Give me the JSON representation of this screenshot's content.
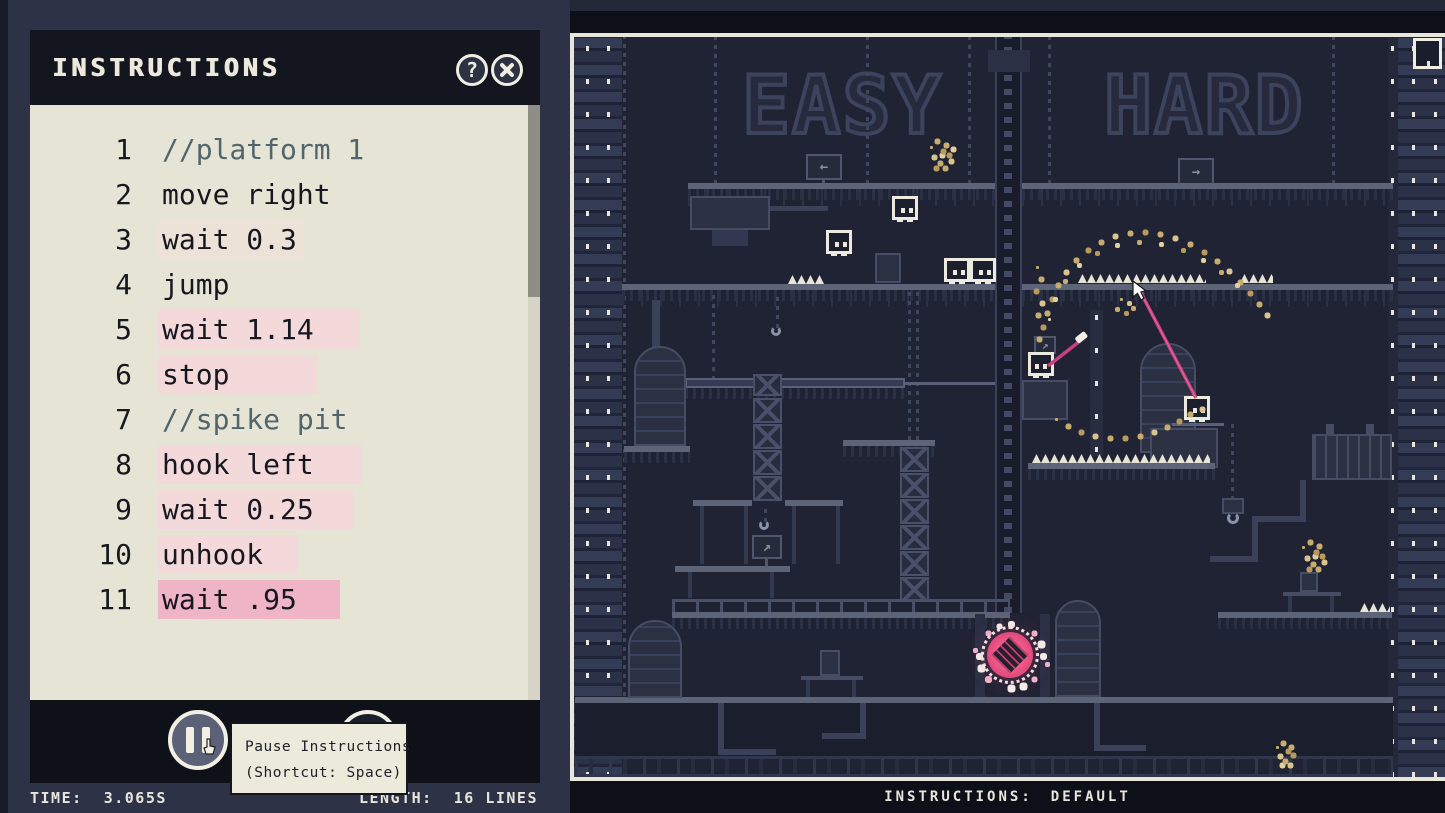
{
  "panel": {
    "title": "INSTRUCTIONS",
    "icons": {
      "help_glyph": "?"
    },
    "tooltip": {
      "line1": "Pause Instructions",
      "line2": "(Shortcut: Space)"
    },
    "footer": {
      "time_label": "TIME:",
      "time_value": "3.065S",
      "length_label": "LENGTH:",
      "length_value": "16 LINES"
    }
  },
  "editor": {
    "lines": [
      {
        "n": 1,
        "text": "//platform 1",
        "type": "comment",
        "highlight": "none",
        "hl_w": 0
      },
      {
        "n": 2,
        "text": "move right",
        "type": "code",
        "highlight": "none",
        "hl_w": 0
      },
      {
        "n": 3,
        "text": "wait 0.3",
        "type": "code",
        "highlight": "faint",
        "hl_w": 140
      },
      {
        "n": 4,
        "text": "jump",
        "type": "code",
        "highlight": "none",
        "hl_w": 0
      },
      {
        "n": 5,
        "text": "wait 1.14",
        "type": "code",
        "highlight": "light",
        "hl_w": 202
      },
      {
        "n": 6,
        "text": "stop",
        "type": "code",
        "highlight": "light",
        "hl_w": 160
      },
      {
        "n": 7,
        "text": "//spike pit",
        "type": "comment",
        "highlight": "none",
        "hl_w": 0
      },
      {
        "n": 8,
        "text": "hook left",
        "type": "code",
        "highlight": "light",
        "hl_w": 204
      },
      {
        "n": 9,
        "text": "wait 0.25",
        "type": "code",
        "highlight": "light",
        "hl_w": 196
      },
      {
        "n": 10,
        "text": "unhook",
        "type": "code",
        "highlight": "light",
        "hl_w": 140
      },
      {
        "n": 11,
        "text": "wait .95",
        "type": "code",
        "highlight": "active",
        "hl_w": 182
      }
    ]
  },
  "game": {
    "easy_label": "EASY",
    "hard_label": "HARD",
    "status_label": "INSTRUCTIONS:",
    "status_value": "DEFAULT",
    "signs": {
      "left": "←",
      "right": "→",
      "diag": "↗"
    },
    "colors": {
      "grapple": "#c9407f",
      "portal": "#e8487c",
      "particle": "#c7ac6e",
      "spike": "#e6e4d6",
      "highlight_active": "#efb4c6",
      "code_bg": "#e6e5d5"
    }
  }
}
